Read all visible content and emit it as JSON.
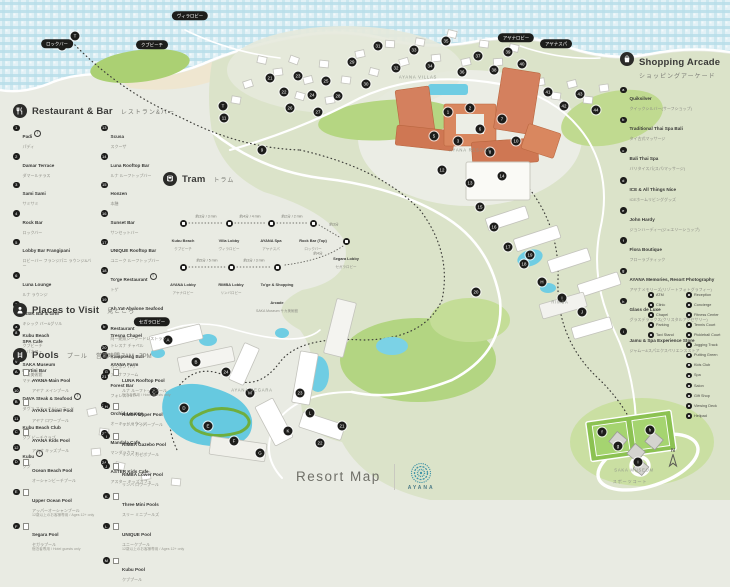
{
  "footer": {
    "title": "Resort Map",
    "brand": "AYANA"
  },
  "compass": {
    "label": "N"
  },
  "colors": {
    "ocean": "#b7dde9",
    "land": "#dce4cb",
    "golf": "#abd073",
    "building_orange": "#d4805e",
    "pool_blue": "#6fcde3",
    "marker_black": "#1d1d1b",
    "logo_teal": "#3f93a6"
  },
  "legend": {
    "restaurant": {
      "title": "Restaurant & Bar",
      "title_jp": "レストラン&バー",
      "col1": [
        {
          "n": "1",
          "name": "Padi",
          "jp": "パディ",
          "b": "T"
        },
        {
          "n": "2",
          "name": "Damar Terrace",
          "jp": "ダマールテラス"
        },
        {
          "n": "3",
          "name": "Sami Sami",
          "jp": "サミサミ"
        },
        {
          "n": "4",
          "name": "Rock Bar",
          "jp": "ロックバー"
        },
        {
          "n": "5",
          "name": "Lobby Bar Frangipani",
          "jp": "ロビーバー フランジパニ ラウンジ&バー"
        },
        {
          "n": "6",
          "name": "Luna Lounge",
          "jp": "ルナ ラウンジ"
        },
        {
          "n": "7",
          "name": "KISIK Bar & Grill",
          "jp": "キシック バー&グリル"
        },
        {
          "n": "8",
          "name": "SPA Cafe",
          "jp": "スパカフェ"
        },
        {
          "n": "9",
          "name": "Martini Bar",
          "jp": "マティーニバー"
        },
        {
          "n": "10",
          "name": "DAVA Steak & Seafood",
          "jp": "ダヴァ ステーキ&シーフード",
          "b": "T"
        },
        {
          "n": "11",
          "name": "Kubu Beach Club",
          "jp": "クブ ビーチクラブ"
        },
        {
          "n": "12",
          "name": "Kubu",
          "jp": "クブ",
          "b": "T"
        }
      ],
      "col2": [
        {
          "n": "13",
          "name": "Scusa",
          "jp": "スクーザ"
        },
        {
          "n": "14",
          "name": "Luna Rooftop Bar",
          "jp": "ルナ ルーフトップバー"
        },
        {
          "n": "15",
          "name": "Honzen",
          "jp": "本膳"
        },
        {
          "n": "16",
          "name": "Sunset Bar",
          "jp": "サンセットバー"
        },
        {
          "n": "17",
          "name": "UNIQUE Rooftop Bar",
          "jp": "ユニーク ルーフトップバー"
        },
        {
          "n": "18",
          "name": "To'ge Restaurant",
          "jp": "トゲ",
          "b": "T"
        },
        {
          "n": "19",
          "name": "Ah Yat Abalone Seafood Restaurant",
          "jp": "阿一鮑魚シーフードレストラン"
        },
        {
          "n": "20",
          "name": "Kampoeng Bali",
          "jp": "カンポン バリ"
        },
        {
          "n": "21",
          "name": "Forest Bar",
          "jp": "フォレストバー"
        },
        {
          "n": "22",
          "name": "Orchid Lounge",
          "jp": "オーキッドラウンジ"
        },
        {
          "n": "23",
          "name": "Mandala Cafe",
          "jp": "マンダラカフェ"
        },
        {
          "n": "24",
          "name": "ASTER Kids Cafe",
          "jp": "アスター キッズカフェ"
        }
      ]
    },
    "places": {
      "title": "Places to Visit",
      "title_jp": "見どころ",
      "items": [
        {
          "n": "a",
          "name": "Kubu Beach",
          "jp": "クブビーチ"
        },
        {
          "n": "b",
          "name": "Tresna Chapel",
          "jp": "トレスナ チャペル"
        },
        {
          "n": "c",
          "name": "SAKA Museum",
          "jp": "サカ美術館"
        },
        {
          "n": "d",
          "name": "AYANA Farm",
          "jp": "アヤナファーム"
        }
      ]
    },
    "pools": {
      "title": "Pools",
      "title_jp": "プール",
      "hours": "営業時間 7AM - 7PM",
      "col1": [
        {
          "n": "A",
          "name": "AYANA Main Pool",
          "jp": "アヤナ メインプール"
        },
        {
          "n": "B",
          "name": "AYANA Lower Pool",
          "jp": "アヤナ ロワープール"
        },
        {
          "n": "C",
          "name": "AYANA Kids Pool",
          "jp": "アヤナ キッズプール"
        },
        {
          "n": "D",
          "name": "Ocean Beach Pool",
          "jp": "オーシャンビーチプール"
        },
        {
          "n": "E",
          "name": "Upper Ocean Pool",
          "jp": "アッパーオーシャンプール",
          "note": "12歳以上のお客様専用 / Ages 12+ only"
        },
        {
          "n": "F",
          "name": "Segara Pool",
          "jp": "セガラプール",
          "note": "宿泊者専用 / Hotel guests only"
        }
      ],
      "col2": [
        {
          "n": "G",
          "name": "LUNA Rooftop Pool",
          "jp": "ルナ ルーフトッププール",
          "note": "宿泊者専用 / Hotel guests only"
        },
        {
          "n": "H",
          "name": "RIMBA Upper Pool",
          "jp": "リンバ アッパープール"
        },
        {
          "n": "I",
          "name": "RIMBA Gazebo Pool",
          "jp": "リンバ ガゼボプール"
        },
        {
          "n": "J",
          "name": "RIMBA Lower Pool",
          "jp": "リンバ ロワープール"
        },
        {
          "n": "K",
          "name": "Three Mini Pools",
          "jp": "スリー ミニプールズ"
        },
        {
          "n": "L",
          "name": "UNIQUE Pool",
          "jp": "ユニークプール",
          "note": "12歳以上のお客様専用 / Ages 12+ only"
        },
        {
          "n": "M",
          "name": "Kubu Pool",
          "jp": "クブプール"
        }
      ]
    },
    "tram": {
      "title": "Tram",
      "title_jp": "トラム",
      "stops": [
        {
          "x": 20,
          "y": 28,
          "name": "Kubu Beach",
          "jp": "クブビーチ"
        },
        {
          "x": 66,
          "y": 28,
          "name": "Villa Lobby",
          "jp": "ヴィラロビー"
        },
        {
          "x": 108,
          "y": 28,
          "name": "AYANA Spa",
          "jp": "アヤナスパ"
        },
        {
          "x": 150,
          "y": 28,
          "name": "Rock Bar (Top)",
          "jp": "ロックバー"
        },
        {
          "x": 183,
          "y": 46,
          "name": "Segara Lobby",
          "jp": "セガラロビー"
        },
        {
          "x": 20,
          "y": 72,
          "name": "AYANA Lobby",
          "jp": "アヤナロビー"
        },
        {
          "x": 68,
          "y": 72,
          "name": "RIMBA Lobby",
          "jp": "リンバロビー"
        },
        {
          "x": 114,
          "y": 72,
          "name": "To'ge & Shopping Arcade",
          "jp": "SAKA Museum サカ美術館"
        }
      ],
      "times": [
        {
          "x": 43,
          "y": 25,
          "t": "約3分 / 3 min"
        },
        {
          "x": 87,
          "y": 25,
          "t": "約4分 / 4 min"
        },
        {
          "x": 129,
          "y": 25,
          "t": "約2分 / 2 min"
        },
        {
          "x": 171,
          "y": 33,
          "t": "約3分"
        },
        {
          "x": 44,
          "y": 69,
          "t": "約5分 / 5 min"
        },
        {
          "x": 91,
          "y": 69,
          "t": "約3分 / 3 min"
        },
        {
          "x": 155,
          "y": 62,
          "t": "約4分"
        }
      ]
    },
    "shopping": {
      "title": "Shopping Arcade",
      "title_jp": "ショッピングアーケード",
      "items": [
        {
          "n": "a",
          "name": "Quiksilver",
          "jp": "クイックシルバー(サーフショップ)"
        },
        {
          "n": "b",
          "name": "Traditional Thai Spa Bali",
          "jp": "タイ古式マッサージ"
        },
        {
          "n": "c",
          "name": "Bali Thai Spa",
          "jp": "バリタイスパ(スパ/マッサージ)"
        },
        {
          "n": "d",
          "name": "ICE & All Things Nice",
          "jp": "ICEホームリビンググッズ"
        },
        {
          "n": "e",
          "name": "John Hardy",
          "jp": "ジョンハーディー(ジュエリーショップ)"
        },
        {
          "n": "f",
          "name": "Flora Boutique",
          "jp": "フローラブティック"
        },
        {
          "n": "g",
          "name": "AYANA Memories, Resort Photography",
          "jp": "アヤナメモリーズ(リゾートフォトグラフィー)"
        },
        {
          "n": "h",
          "name": "Glass de Luxe",
          "jp": "グラスデラックス(クリスタルアクセサリー)"
        },
        {
          "n": "i",
          "name": "Jamu & Spa Experience Store",
          "jp": "ジャムー&スパエクスペリエンスストア"
        }
      ]
    },
    "facilities": {
      "col1": [
        {
          "name": "ATM"
        },
        {
          "name": "Clinic"
        },
        {
          "name": "Chapel"
        },
        {
          "name": "Parking"
        },
        {
          "name": "Taxi Stand"
        }
      ],
      "col2": [
        {
          "name": "Reception"
        },
        {
          "name": "Concierge"
        },
        {
          "name": "Fitness Center"
        },
        {
          "name": "Tennis Court"
        },
        {
          "name": "Pickleball Court"
        },
        {
          "name": "Jogging Track"
        },
        {
          "name": "Putting Green"
        },
        {
          "name": "Kids Club"
        },
        {
          "name": "Spa"
        },
        {
          "name": "Salon"
        },
        {
          "name": "Gift Shop"
        },
        {
          "name": "Viewing Deck"
        },
        {
          "name": "Helipad"
        }
      ]
    }
  },
  "map": {
    "pills": [
      {
        "x": 57,
        "y": 44,
        "t": "ロックバー"
      },
      {
        "x": 152,
        "y": 45,
        "t": "クブビーチ"
      },
      {
        "x": 190,
        "y": 16,
        "t": "ヴィラロビー"
      },
      {
        "x": 516,
        "y": 38,
        "t": "アヤナロビー"
      },
      {
        "x": 556,
        "y": 44,
        "t": "アヤナスパ"
      },
      {
        "x": 152,
        "y": 322,
        "t": "セガラロビー"
      }
    ],
    "labels": [
      {
        "x": 418,
        "y": 77,
        "t": "AYANA VILLAS"
      },
      {
        "x": 470,
        "y": 150,
        "t": "AYANA RESORT"
      },
      {
        "x": 560,
        "y": 302,
        "t": "RIMBA"
      },
      {
        "x": 252,
        "y": 390,
        "t": "AYANA SEGARA"
      },
      {
        "x": 634,
        "y": 470,
        "t": "SAKA MUSEUM"
      },
      {
        "x": 630,
        "y": 482,
        "t": "スポーツコート"
      }
    ],
    "markers": [
      {
        "x": 75,
        "y": 36,
        "t": "T"
      },
      {
        "x": 62,
        "y": 46,
        "t": "4"
      },
      {
        "x": 223,
        "y": 106,
        "t": "T"
      },
      {
        "x": 224,
        "y": 118,
        "t": "11"
      },
      {
        "x": 262,
        "y": 150,
        "t": "9"
      },
      {
        "x": 270,
        "y": 78,
        "t": "21"
      },
      {
        "x": 284,
        "y": 92,
        "t": "22"
      },
      {
        "x": 298,
        "y": 76,
        "t": "23"
      },
      {
        "x": 312,
        "y": 95,
        "t": "24"
      },
      {
        "x": 326,
        "y": 81,
        "t": "25"
      },
      {
        "x": 290,
        "y": 108,
        "t": "26"
      },
      {
        "x": 318,
        "y": 112,
        "t": "27"
      },
      {
        "x": 338,
        "y": 96,
        "t": "28"
      },
      {
        "x": 352,
        "y": 62,
        "t": "29"
      },
      {
        "x": 366,
        "y": 84,
        "t": "30"
      },
      {
        "x": 378,
        "y": 46,
        "t": "31"
      },
      {
        "x": 396,
        "y": 68,
        "t": "32"
      },
      {
        "x": 414,
        "y": 50,
        "t": "33"
      },
      {
        "x": 430,
        "y": 66,
        "t": "34"
      },
      {
        "x": 446,
        "y": 41,
        "t": "35"
      },
      {
        "x": 462,
        "y": 72,
        "t": "36"
      },
      {
        "x": 478,
        "y": 56,
        "t": "37"
      },
      {
        "x": 494,
        "y": 70,
        "t": "38"
      },
      {
        "x": 508,
        "y": 52,
        "t": "39"
      },
      {
        "x": 522,
        "y": 64,
        "t": "40"
      },
      {
        "x": 448,
        "y": 112,
        "t": "1"
      },
      {
        "x": 470,
        "y": 108,
        "t": "2"
      },
      {
        "x": 434,
        "y": 136,
        "t": "5"
      },
      {
        "x": 458,
        "y": 141,
        "t": "3"
      },
      {
        "x": 480,
        "y": 129,
        "t": "6"
      },
      {
        "x": 502,
        "y": 119,
        "t": "7"
      },
      {
        "x": 490,
        "y": 152,
        "t": "8"
      },
      {
        "x": 516,
        "y": 141,
        "t": "10"
      },
      {
        "x": 442,
        "y": 170,
        "t": "12"
      },
      {
        "x": 470,
        "y": 183,
        "t": "13"
      },
      {
        "x": 502,
        "y": 176,
        "t": "14"
      },
      {
        "x": 548,
        "y": 92,
        "t": "41"
      },
      {
        "x": 564,
        "y": 106,
        "t": "42"
      },
      {
        "x": 580,
        "y": 94,
        "t": "43"
      },
      {
        "x": 596,
        "y": 110,
        "t": "44"
      },
      {
        "x": 480,
        "y": 207,
        "t": "15"
      },
      {
        "x": 494,
        "y": 227,
        "t": "16"
      },
      {
        "x": 508,
        "y": 247,
        "t": "17"
      },
      {
        "x": 524,
        "y": 264,
        "t": "18"
      },
      {
        "x": 542,
        "y": 282,
        "t": "H"
      },
      {
        "x": 562,
        "y": 298,
        "t": "I"
      },
      {
        "x": 582,
        "y": 312,
        "t": "J"
      },
      {
        "x": 530,
        "y": 255,
        "t": "19"
      },
      {
        "x": 476,
        "y": 292,
        "t": "20"
      },
      {
        "x": 168,
        "y": 340,
        "t": "A"
      },
      {
        "x": 196,
        "y": 362,
        "t": "B"
      },
      {
        "x": 154,
        "y": 392,
        "t": "C"
      },
      {
        "x": 184,
        "y": 408,
        "t": "D"
      },
      {
        "x": 208,
        "y": 426,
        "t": "E"
      },
      {
        "x": 234,
        "y": 441,
        "t": "F"
      },
      {
        "x": 260,
        "y": 453,
        "t": "G"
      },
      {
        "x": 288,
        "y": 431,
        "t": "K"
      },
      {
        "x": 310,
        "y": 413,
        "t": "L"
      },
      {
        "x": 250,
        "y": 393,
        "t": "M"
      },
      {
        "x": 226,
        "y": 372,
        "t": "24"
      },
      {
        "x": 300,
        "y": 393,
        "t": "23"
      },
      {
        "x": 320,
        "y": 443,
        "t": "22"
      },
      {
        "x": 342,
        "y": 426,
        "t": "21"
      },
      {
        "x": 602,
        "y": 432,
        "t": "f"
      },
      {
        "x": 618,
        "y": 446,
        "t": "g"
      },
      {
        "x": 650,
        "y": 430,
        "t": "h"
      },
      {
        "x": 638,
        "y": 462,
        "t": "i"
      }
    ]
  }
}
